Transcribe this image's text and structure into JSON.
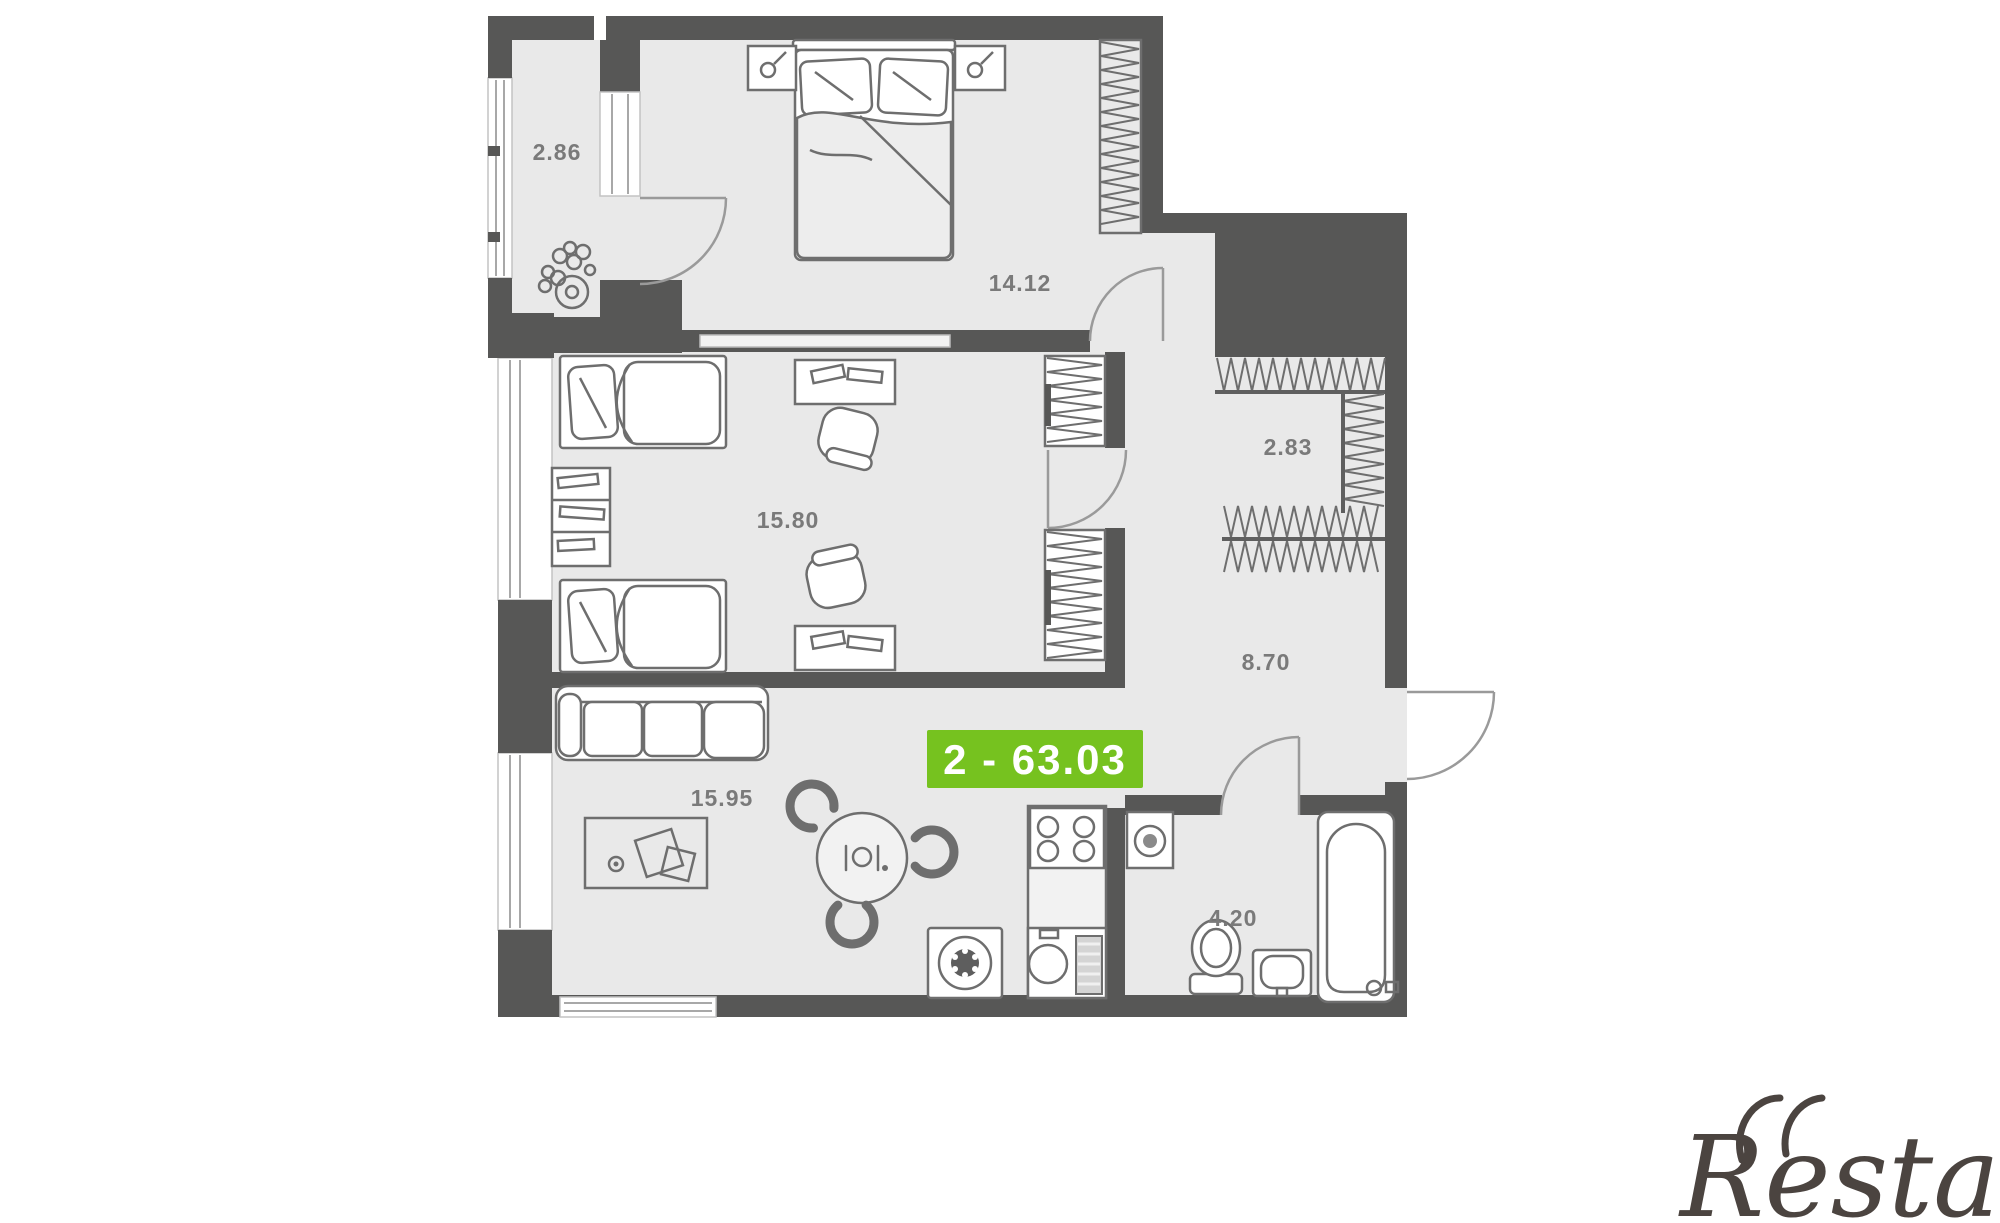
{
  "canvas": {
    "width": 2000,
    "height": 1223,
    "background": "#ffffff"
  },
  "plan": {
    "colors": {
      "floor": "#e9e9e9",
      "walls": "#575756",
      "furniture_stroke": "#6e6e6e",
      "label_color": "#7a7a7a"
    },
    "rooms": [
      {
        "id": "balcony",
        "area_label": "2.86"
      },
      {
        "id": "bedroom",
        "area_label": "14.12"
      },
      {
        "id": "children-room",
        "area_label": "15.80"
      },
      {
        "id": "wardrobe-hall",
        "area_label": "2.83"
      },
      {
        "id": "hallway",
        "area_label": "8.70"
      },
      {
        "id": "living-kitchen",
        "area_label": "15.95"
      },
      {
        "id": "bathroom",
        "area_label": "4.20"
      }
    ],
    "area_badge": {
      "text": "2 - 63.03",
      "rooms_count": "2",
      "total_area_m2": "63.03",
      "background": "#76c21f",
      "text_color": "#ffffff"
    }
  },
  "watermark": {
    "text": "Restate",
    "color": "#4b4440"
  }
}
